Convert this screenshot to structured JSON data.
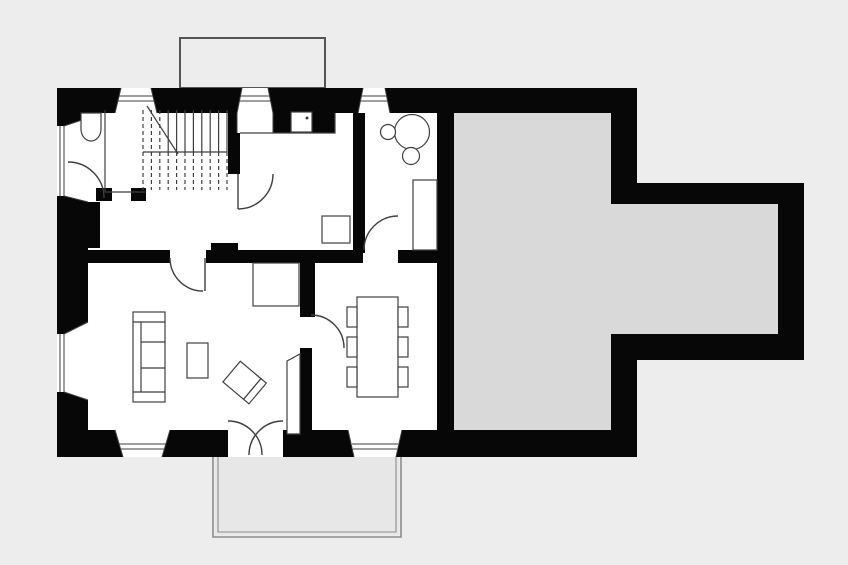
{
  "meta": {
    "view": "ground-floor-plan",
    "visible_text": []
  },
  "palette": {
    "background": "#ededed",
    "room": "#ffffff",
    "wall": "#070707",
    "wing": "#d9d9d9",
    "line": "#3f3f3f",
    "terrace-line": "#8c8c8c",
    "terrace-fill": "#e7e7e7",
    "annex-line": "#555555"
  },
  "inventory": {
    "structures": [
      "main-house",
      "gray-side-wing",
      "right-extension",
      "roof-annex-outline",
      "terrace"
    ],
    "fixtures": [
      "staircase",
      "toilet",
      "kitchen-sink",
      "kitchen-appliance",
      "fireplace",
      "round-table",
      "stool",
      "stool",
      "built-in-closet",
      "sofa",
      "coffee-table",
      "armchair",
      "dining-table",
      "dining-chairs"
    ],
    "dining_chair_count": 6,
    "stair_tread_count": 11,
    "window_count": 7,
    "door_arc_count": 7
  }
}
